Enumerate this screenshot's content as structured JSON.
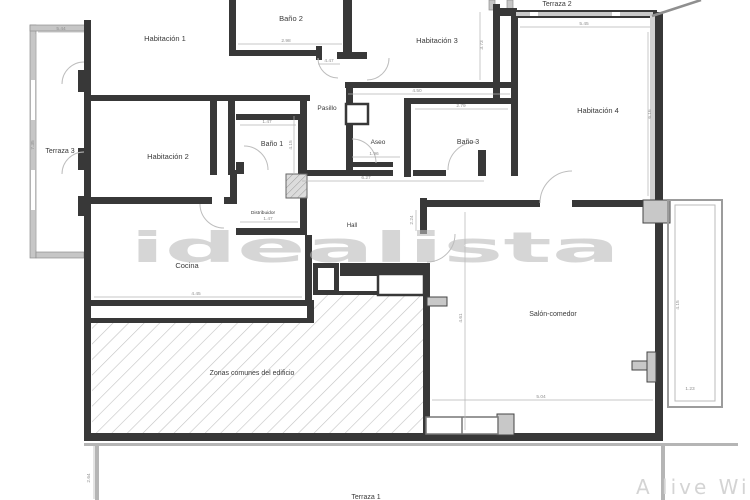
{
  "plan": {
    "type": "floor-plan",
    "watermark_center": "idealista",
    "watermark_corner": "A live Wi",
    "rooms": [
      {
        "id": "habitacion-1",
        "label": "Habitación 1"
      },
      {
        "id": "bano-2",
        "label": "Baño 2"
      },
      {
        "id": "habitacion-3",
        "label": "Habitación 3"
      },
      {
        "id": "habitacion-4",
        "label": "Habitación 4"
      },
      {
        "id": "terraza-3",
        "label": "Terraza 3"
      },
      {
        "id": "habitacion-2",
        "label": "Habitación 2"
      },
      {
        "id": "bano-1",
        "label": "Baño 1"
      },
      {
        "id": "pasillo",
        "label": "Pasillo"
      },
      {
        "id": "aseo",
        "label": "Aseo"
      },
      {
        "id": "bano-3",
        "label": "Baño 3"
      },
      {
        "id": "distribuidor",
        "label": "Distribuidor"
      },
      {
        "id": "hall",
        "label": "Hall"
      },
      {
        "id": "cocina",
        "label": "Cocina"
      },
      {
        "id": "salon-comedor",
        "label": "Salón-comedor"
      },
      {
        "id": "zonas-comunes",
        "label": "Zonas comunes del edificio"
      },
      {
        "id": "terraza-2",
        "label": "Terraza 2"
      },
      {
        "id": "terraza-1",
        "label": "Terraza 1"
      }
    ],
    "dims": [
      "5.44",
      "2.98",
      "4.47",
      "3.73",
      "4.50",
      "2.79",
      "5.45",
      "6.16",
      "1.47",
      "4.15",
      "1.96",
      "6.27",
      "1.47",
      "2.24",
      "4.45",
      "4.61",
      "5.04",
      "4.15",
      "1.23",
      "2.64",
      "7.35"
    ]
  },
  "colors": {
    "wall": "#383838",
    "light_wall": "#c6c6c6",
    "hatch_line": "#c2c2c2",
    "label": "#3a3a3a",
    "dimension": "#8f8f8f",
    "watermark": "#bcbcbc",
    "background": "#ffffff"
  }
}
